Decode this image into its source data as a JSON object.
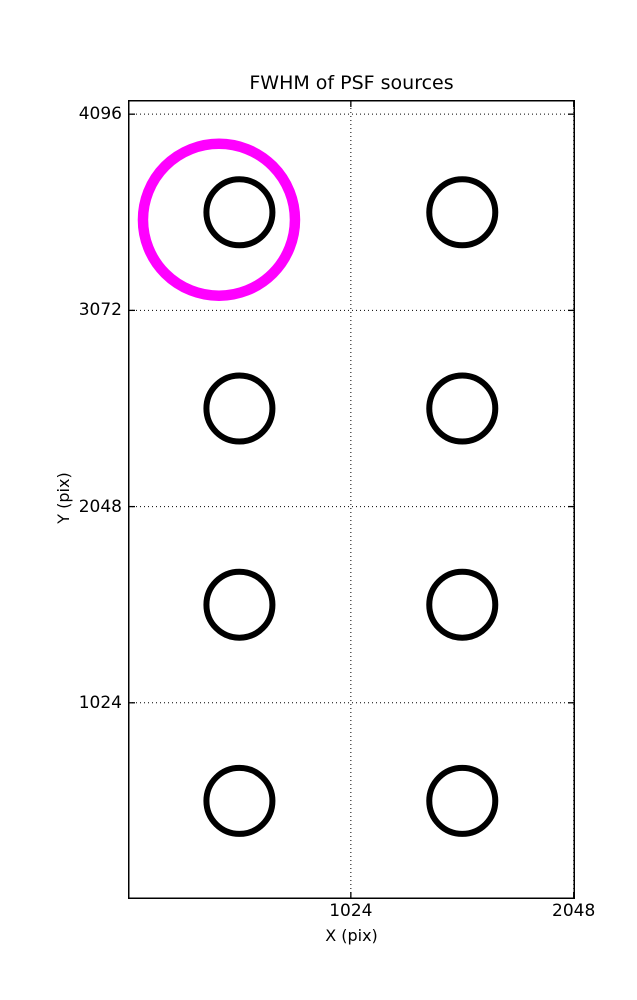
{
  "figure": {
    "background": "#ffffff",
    "text_color": "#000000"
  },
  "chart_data": {
    "type": "scatter",
    "title": "FWHM of PSF sources",
    "xlabel": "X (pix)",
    "ylabel": "Y (pix)",
    "xlim": [
      0,
      2054
    ],
    "ylim": [
      0,
      4170
    ],
    "xticks": [
      1024,
      2048
    ],
    "yticks": [
      1024,
      2048,
      3072,
      4096
    ],
    "grid": {
      "on": true,
      "style": "dotted",
      "color": "#000000"
    },
    "legend": "none",
    "series": [
      {
        "name": "psf-sources",
        "marker": "open-circle",
        "color": "#000000",
        "marker_radius_px": 33,
        "marker_stroke_px": 6,
        "points": [
          {
            "x": 512,
            "y": 3584
          },
          {
            "x": 1536,
            "y": 3584
          },
          {
            "x": 512,
            "y": 2560
          },
          {
            "x": 1536,
            "y": 2560
          },
          {
            "x": 512,
            "y": 1536
          },
          {
            "x": 1536,
            "y": 1536
          },
          {
            "x": 512,
            "y": 512
          },
          {
            "x": 1536,
            "y": 512
          }
        ]
      },
      {
        "name": "highlighted-source",
        "marker": "open-circle",
        "color": "#ff00ff",
        "marker_radius_px": 76,
        "marker_stroke_px": 10.5,
        "points": [
          {
            "x": 418,
            "y": 3545
          }
        ]
      }
    ]
  }
}
